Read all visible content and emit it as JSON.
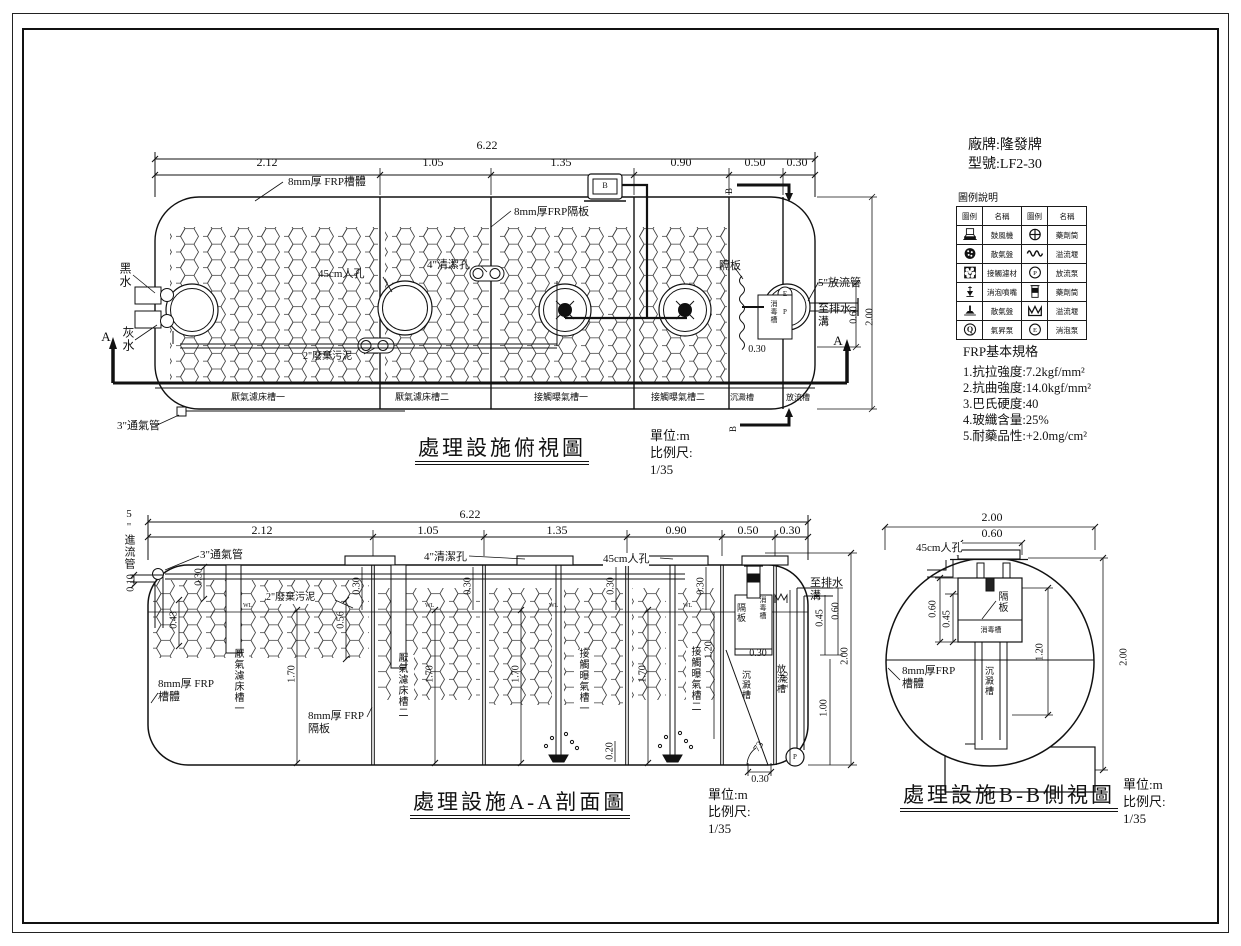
{
  "titleblock": {
    "manufacturer": "廠牌:隆發牌",
    "model": "型號:LF2-30"
  },
  "units": {
    "unit": "單位:m",
    "scale_label": "比例尺:",
    "scale": "1/35"
  },
  "marks": {
    "a": "A",
    "b": "B",
    "e": "E",
    "p": "P",
    "q": "Q",
    "wl": "WL"
  },
  "legend": {
    "title": "圖例說明",
    "headers": [
      "圖例",
      "名稱",
      "圖例",
      "名稱"
    ],
    "rows": [
      {
        "l_icon": "blower-plan-icon",
        "l": "鼓風機",
        "r_icon": "chemical-feeder-plan-icon",
        "r": "藥劑筒"
      },
      {
        "l_icon": "air-diffuser-plan-icon",
        "l": "散氣盤",
        "r_icon": "overflow-weir-plan-icon",
        "r": "溢流堰"
      },
      {
        "l_icon": "contact-media-icon",
        "l": "接觸濾材",
        "r_icon": "effluent-pump-icon",
        "r": "放流泵"
      },
      {
        "l_icon": "defoam-nozzle-icon",
        "l": "消泡噴嘴",
        "r_icon": "chemical-feeder-side-icon",
        "r": "藥劑筒"
      },
      {
        "l_icon": "air-diffuser-side-icon",
        "l": "散氣盤",
        "r_icon": "overflow-weir-side-icon",
        "r": "溢流堰"
      },
      {
        "l_icon": "airlift-pump-icon",
        "l": "氣昇泵",
        "r_icon": "defoam-pump-icon",
        "r": "消泡泵"
      }
    ]
  },
  "frp": {
    "title": "FRP基本規格",
    "items": [
      "1.抗拉強度:7.2kgf/mm²",
      "2.抗曲強度:14.0kgf/mm²",
      "3.巴氏硬度:40",
      "4.玻纖含量:25%",
      "5.耐藥品性:+2.0mg/cm²"
    ]
  },
  "top_view": {
    "title": "處理設施俯視圖",
    "dim_total": "6.22",
    "dims": [
      "2.12",
      "1.05",
      "1.35",
      "0.90",
      "0.50",
      "0.30"
    ],
    "vdims": {
      "d060": "0.60",
      "d200": "2.00",
      "d030": "0.30"
    },
    "labels": {
      "shell": "8mm厚 FRP槽體",
      "baffle": "8mm厚FRP隔板",
      "manhole": "45cm人孔",
      "clean_hole": "4\"清潔孔",
      "waste": "2\"廢棄污泥",
      "black_water": "黑水",
      "grey_water": "灰水",
      "vent": "3\"通氣管",
      "outlet": "5\"放流管",
      "to_ditch": "至排水溝",
      "partition": "隔板",
      "disinfect": "消毒槽"
    },
    "chambers": [
      "厭氣濾床槽一",
      "厭氣濾床槽二",
      "接觸曝氣槽一",
      "接觸曝氣槽二",
      "沉澱槽",
      "放流槽"
    ]
  },
  "section_aa": {
    "title": "處理設施A-A剖面圖",
    "dim_total": "6.22",
    "dims": [
      "2.12",
      "1.05",
      "1.35",
      "0.90",
      "0.50",
      "0.30"
    ],
    "vdims": {
      "d010": "0.10",
      "d030": "0.30",
      "d043": "0.43",
      "d056": "0.56",
      "d170": "1.70",
      "d120": "1.20",
      "d020": "0.20",
      "d165": "1.65",
      "d100": "1.00",
      "d200": "2.00",
      "d045": "0.45",
      "d060": "0.60",
      "angle": "73"
    },
    "labels": {
      "inlet": "5\"進流管",
      "vent": "3\"通氣管",
      "clean_hole": "4\"清潔孔",
      "manhole": "45cm人孔",
      "waste": "2\"廢棄污泥",
      "shell": "8mm厚 FRP槽體",
      "baffle": "8mm厚 FRP隔板",
      "partition": "隔板",
      "disinfect": "消毒槽",
      "to_ditch": "至排水溝"
    },
    "chambers": [
      "厭氣濾床槽一",
      "厭氣濾床槽二",
      "接觸曝氣槽一",
      "接觸曝氣槽二",
      "沉澱槽",
      "放流槽"
    ]
  },
  "bb_view": {
    "title": "處理設施B-B側視圖",
    "dims": {
      "w200": "2.00",
      "w060": "0.60",
      "d060": "0.60",
      "d045": "0.45",
      "d120": "1.20",
      "h200": "2.00"
    },
    "labels": {
      "manhole": "45cm人孔",
      "partition": "隔板",
      "disinfect": "消毒槽",
      "sediment": "沉澱槽",
      "shell": "8mm厚FRP槽體"
    }
  }
}
